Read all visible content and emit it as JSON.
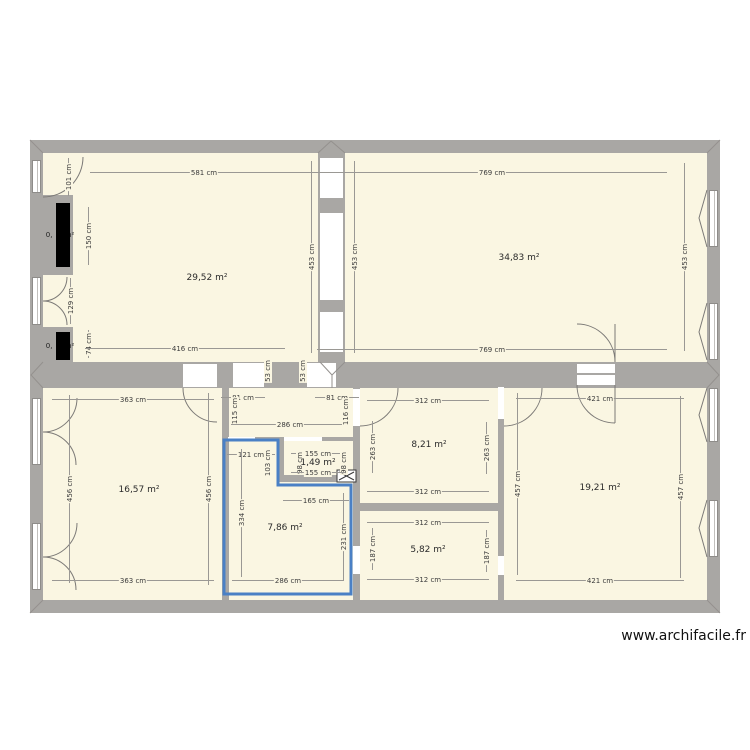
{
  "watermark": "www.archifacile.fr",
  "colors": {
    "room_fill": "#faf6e2",
    "wall": "#a9a7a4",
    "selection_blue": "#4a80c5",
    "conduit_black": "#000000",
    "dim_text": "#3c3c3c"
  },
  "rooms": [
    {
      "area_label": "29,52 m²",
      "x": 207,
      "y": 278,
      "selected": false
    },
    {
      "area_label": "34,83 m²",
      "x": 519,
      "y": 258,
      "selected": false
    },
    {
      "area_label": "16,57 m²",
      "x": 139,
      "y": 490,
      "selected": false
    },
    {
      "area_label": "8,21 m²",
      "x": 429,
      "y": 445,
      "selected": false
    },
    {
      "area_label": "1,49 m²",
      "x": 318,
      "y": 463,
      "selected": false
    },
    {
      "area_label": "7,86 m²",
      "x": 285,
      "y": 528,
      "selected": true
    },
    {
      "area_label": "5,82 m²",
      "x": 428,
      "y": 550,
      "selected": false
    },
    {
      "area_label": "19,21 m²",
      "x": 600,
      "y": 488,
      "selected": false
    }
  ],
  "conduits": [
    {
      "area_label": "0, m²",
      "x": 60,
      "y": 235
    },
    {
      "area_label": "0, m²",
      "x": 60,
      "y": 346
    }
  ],
  "dims": [
    {
      "t": "581 cm",
      "x": 204,
      "y": 172,
      "o": "h",
      "l": 228
    },
    {
      "t": "101 cm",
      "x": 68,
      "y": 177,
      "o": "v",
      "l": 38
    },
    {
      "t": "150 cm",
      "x": 88,
      "y": 236,
      "o": "v",
      "l": 58
    },
    {
      "t": "129 cm",
      "x": 70,
      "y": 301,
      "o": "v",
      "l": 46
    },
    {
      "t": "74 cm",
      "x": 88,
      "y": 344,
      "o": "v",
      "l": 28
    },
    {
      "t": "416 cm",
      "x": 185,
      "y": 348,
      "o": "h",
      "l": 200
    },
    {
      "t": "453 cm",
      "x": 311,
      "y": 257,
      "o": "v",
      "l": 192
    },
    {
      "t": "53 cm",
      "x": 267,
      "y": 371,
      "o": "v",
      "l": 20
    },
    {
      "t": "53 cm",
      "x": 302,
      "y": 371,
      "o": "v",
      "l": 20
    },
    {
      "t": "769 cm",
      "x": 492,
      "y": 172,
      "o": "h",
      "l": 350
    },
    {
      "t": "453 cm",
      "x": 354,
      "y": 257,
      "o": "v",
      "l": 192
    },
    {
      "t": "453 cm",
      "x": 684,
      "y": 257,
      "o": "v",
      "l": 188
    },
    {
      "t": "769 cm",
      "x": 492,
      "y": 349,
      "o": "h",
      "l": 350
    },
    {
      "t": "363 cm",
      "x": 133,
      "y": 399,
      "o": "h",
      "l": 162
    },
    {
      "t": "456 cm",
      "x": 69,
      "y": 489,
      "o": "v",
      "l": 188
    },
    {
      "t": "456 cm",
      "x": 208,
      "y": 489,
      "o": "v",
      "l": 192
    },
    {
      "t": "363 cm",
      "x": 133,
      "y": 580,
      "o": "h",
      "l": 162
    },
    {
      "t": "81 cm",
      "x": 243,
      "y": 397,
      "o": "h",
      "l": 44
    },
    {
      "t": "115 cm",
      "x": 234,
      "y": 411,
      "o": "v",
      "l": 28
    },
    {
      "t": "286 cm",
      "x": 290,
      "y": 424,
      "o": "h",
      "l": 118
    },
    {
      "t": "81 cm",
      "x": 337,
      "y": 397,
      "o": "h",
      "l": 44
    },
    {
      "t": "116 cm",
      "x": 345,
      "y": 412,
      "o": "v",
      "l": 28
    },
    {
      "t": "121 cm",
      "x": 251,
      "y": 454,
      "o": "h",
      "l": 48
    },
    {
      "t": "103 cm",
      "x": 267,
      "y": 463,
      "o": "v",
      "l": 26
    },
    {
      "t": "334 cm",
      "x": 241,
      "y": 513,
      "o": "v",
      "l": 128
    },
    {
      "t": "165 cm",
      "x": 316,
      "y": 500,
      "o": "h",
      "l": 66
    },
    {
      "t": "231 cm",
      "x": 343,
      "y": 537,
      "o": "v",
      "l": 88
    },
    {
      "t": "286 cm",
      "x": 288,
      "y": 580,
      "o": "h",
      "l": 112
    },
    {
      "t": "155 cm",
      "x": 318,
      "y": 453,
      "o": "h",
      "l": 54
    },
    {
      "t": "98 cm",
      "x": 299,
      "y": 463,
      "o": "v",
      "l": 20
    },
    {
      "t": "98 cm",
      "x": 343,
      "y": 463,
      "o": "v",
      "l": 20
    },
    {
      "t": "155 cm",
      "x": 318,
      "y": 472,
      "o": "h",
      "l": 54
    },
    {
      "t": "312 cm",
      "x": 428,
      "y": 400,
      "o": "h",
      "l": 122
    },
    {
      "t": "263 cm",
      "x": 372,
      "y": 447,
      "o": "v",
      "l": 52
    },
    {
      "t": "263 cm",
      "x": 486,
      "y": 448,
      "o": "v",
      "l": 52
    },
    {
      "t": "312 cm",
      "x": 428,
      "y": 491,
      "o": "h",
      "l": 122
    },
    {
      "t": "312 cm",
      "x": 428,
      "y": 522,
      "o": "h",
      "l": 122
    },
    {
      "t": "187 cm",
      "x": 372,
      "y": 549,
      "o": "v",
      "l": 42
    },
    {
      "t": "187 cm",
      "x": 486,
      "y": 551,
      "o": "v",
      "l": 42
    },
    {
      "t": "312 cm",
      "x": 428,
      "y": 579,
      "o": "h",
      "l": 122
    },
    {
      "t": "421 cm",
      "x": 600,
      "y": 398,
      "o": "h",
      "l": 168
    },
    {
      "t": "457 cm",
      "x": 517,
      "y": 484,
      "o": "v",
      "l": 182
    },
    {
      "t": "457 cm",
      "x": 680,
      "y": 487,
      "o": "v",
      "l": 182
    },
    {
      "t": "421 cm",
      "x": 600,
      "y": 580,
      "o": "h",
      "l": 168
    }
  ]
}
